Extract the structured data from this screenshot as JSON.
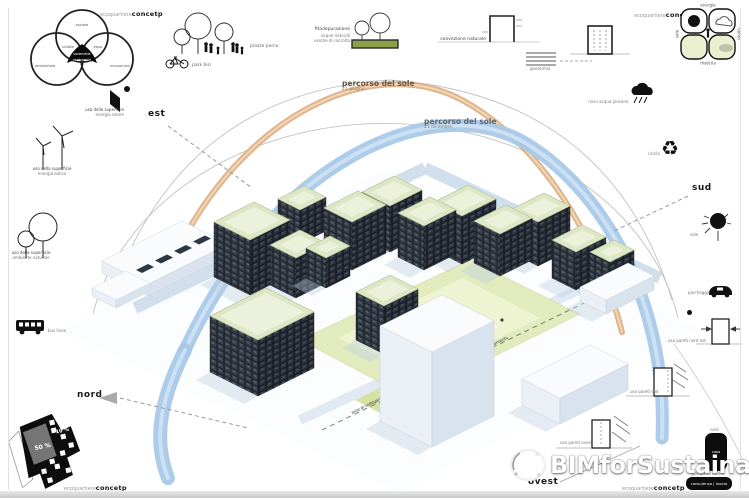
{
  "brand": {
    "prefix": "ecoquartiere",
    "name": "concetp"
  },
  "colors": {
    "summer_arc": "#dcab80",
    "winter_arc": "#a6c8e8",
    "roof_green": "#dde7c6",
    "park_green": "#e2ebbd",
    "facade_dark": "#20262e",
    "accent_black": "#111111"
  },
  "venn": {
    "top": "sociale",
    "left": "ambientale",
    "right": "economico",
    "overlap_left": "vivibile",
    "overlap_right": "equo",
    "center_line1": "sostenibile",
    "center_line2": "realizzabile"
  },
  "top_icons": {
    "park_label": "piazze parco",
    "bike_label": "park bici",
    "fito_line1": "fitodepurazione",
    "fito_line2": "acque naturali",
    "fito_line3": "vasche di raccolta",
    "convection_label": "convezione naturale",
    "geothermal_label": "geotermia",
    "rain_label": "riuso acqua piovana"
  },
  "matrix": {
    "top": "energia",
    "bottom": "materia",
    "left": "sole",
    "right": "vento"
  },
  "right_icons": {
    "recycle_label": "ricicla",
    "sun_label": "sole",
    "parking_label": "parcheggio",
    "walls_ne_label": "uso pareti nord est",
    "walls_sud_label": "uso pareti sud",
    "walls_ovest_label": "uso pareti ovest",
    "note_label": "note",
    "casa_label": "casa",
    "pump_label": "pompa di calore",
    "consult_label": "consulenza | lavoro"
  },
  "left_icons": {
    "solar_line1": "uso della superficie",
    "solar_line2": "energia solare",
    "wind_line1": "uso della superficie",
    "wind_line2": "energia eolica",
    "nature_line1": "uso della superficie",
    "nature_line2": "ambiente naturale",
    "bus_label": "bus linea"
  },
  "sun_paths": {
    "summer_title": "percorso del sole",
    "summer_sub": "21 giugno",
    "winter_title": "percorso del sole",
    "winter_sub": "21 dicembre"
  },
  "compass": {
    "est": "est",
    "sud": "sud",
    "nord": "nord",
    "ovest": "ovest"
  },
  "site_plan": {
    "gray_pct": "50 %",
    "small_pct": "10 %"
  },
  "ground_axes": {
    "axis1": "asse di collegamento",
    "axis2": "asse di collegamento"
  },
  "watermark": {
    "text": "BIMforSustainability"
  }
}
